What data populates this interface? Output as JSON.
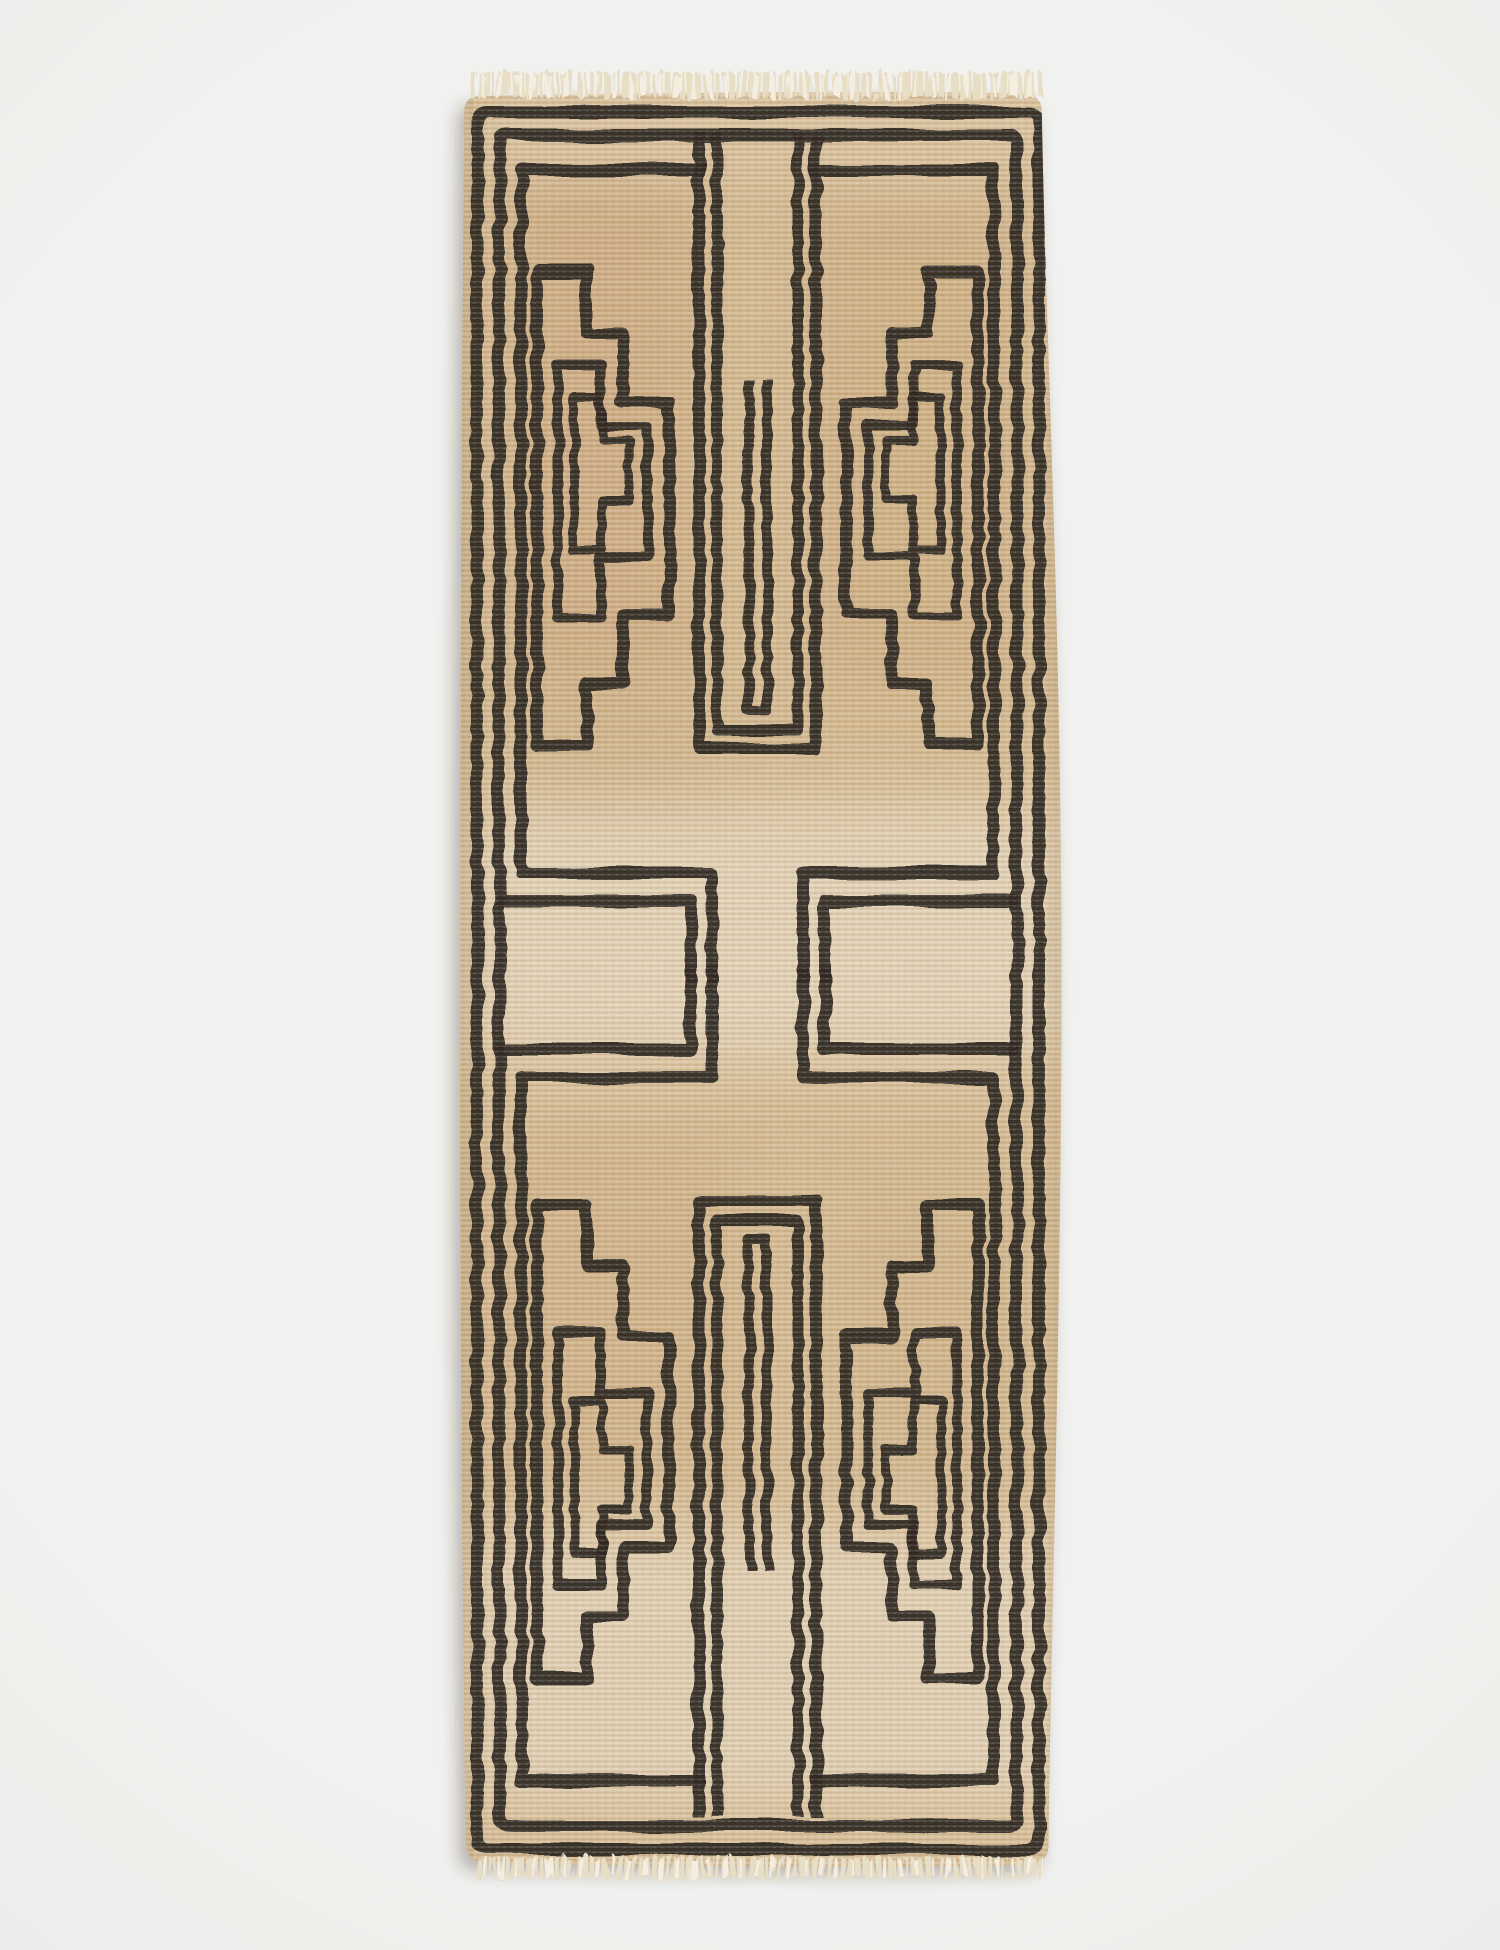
{
  "scene": {
    "background_color": "#f1f1ef",
    "vignette_color": "rgba(60,55,48,0.05)",
    "shadow_color": "rgba(52,44,33,0.30)",
    "description": "Studio product photograph of a vintage hand-knotted runner rug laid flat on a light gray seamless backdrop, shot from directly above.",
    "alt_text": "Vintage runner rug with camel-tan ground, black stepped geometric line motifs, double-line borders, and cream fringe at the top and bottom ends"
  },
  "rug": {
    "name": "geometric-stepped-runner-rug",
    "orientation": "vertical runner",
    "motif_style": "mirrored stepped ziggurat panels with nested outlines, double-line perimeter border, central forked channel repeated top and bottom",
    "colors": {
      "base": "#d6bb91",
      "pattern": "#251d14",
      "fringe": "#e8ddc5",
      "fringe_light": "#f4eee0",
      "weave_highlight": "rgba(255,255,255,0.13)",
      "weave_shadow": "rgba(116,86,52,0.11)",
      "warm_patch": "rgba(178,126,70,0.20)",
      "pale_patch": "rgba(248,242,230,0.42)",
      "edge_shade": "rgba(70,52,34,0.07)",
      "grain": "#3a2f22"
    },
    "features": [
      "double outer border lines",
      "stepped panel motifs pointing toward center",
      "nested inner motif outlines",
      "central three-line forked channel",
      "cream fringe top and bottom"
    ]
  }
}
